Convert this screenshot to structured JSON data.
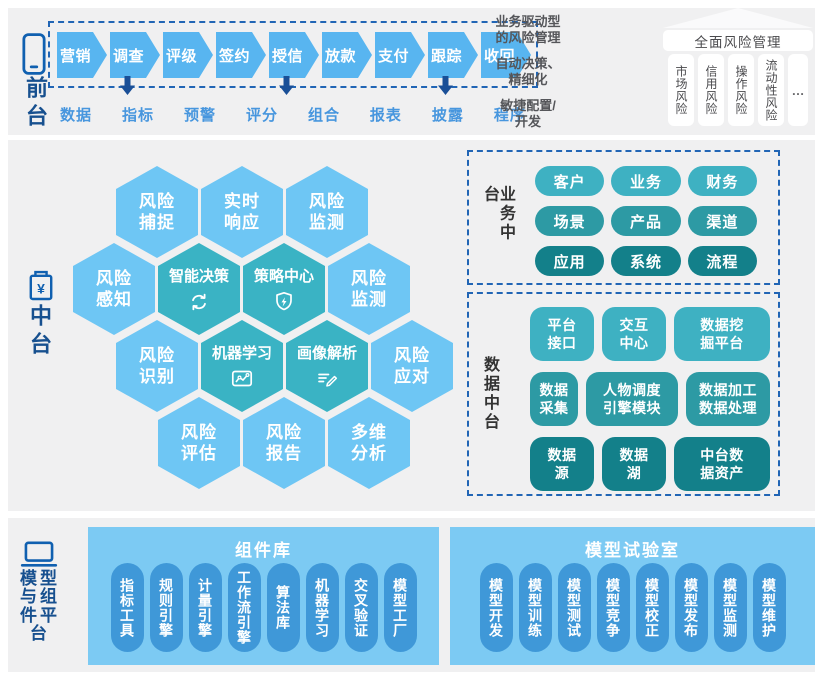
{
  "palette": {
    "band_bg": "#f0f0f1",
    "arrow_blue": "#58b5f0",
    "dashed_border_blue": "#2165b5",
    "down_arrow_navy": "#1a4f97",
    "flow_label_blue": "#4796de",
    "rail_navy": "#17508f",
    "hex_light_blue": "#6ec6f4",
    "hex_teal": "#3ab3c4",
    "pill_teal_light": "#3eb1c2",
    "pill_teal_mid": "#2d9aa4",
    "pill_teal_dark": "#13808a",
    "panel_sky_blue": "#7ccaf3",
    "panel_pill_blue": "#3f98d8"
  },
  "front": {
    "label": "前台",
    "steps": [
      {
        "label": "营销"
      },
      {
        "label": "调查",
        "down": true
      },
      {
        "label": "评级"
      },
      {
        "label": "签约"
      },
      {
        "label": "授信",
        "down": true
      },
      {
        "label": "放款"
      },
      {
        "label": "支付"
      },
      {
        "label": "跟踪",
        "down": true
      },
      {
        "label": "收回"
      }
    ],
    "sub_labels": [
      "数据",
      "指标",
      "预警",
      "评分",
      "组合",
      "报表",
      "披露",
      "程序"
    ],
    "features": [
      {
        "l1": "业务驱动型",
        "l2": "的风险管理"
      },
      {
        "l1": "自动决策、",
        "l2": "精细化"
      },
      {
        "l1": "敏捷配置/",
        "l2": "开发"
      }
    ],
    "comprehensive": {
      "title": "全面风险管理",
      "items": [
        "市场风险",
        "信用风险",
        "操作风险",
        "流动性风险",
        "…"
      ]
    }
  },
  "middle": {
    "label": "中台",
    "hexes": [
      {
        "l1": "风险",
        "l2": "捕捉"
      },
      {
        "l1": "实时",
        "l2": "响应"
      },
      {
        "l1": "风险",
        "l2": "监测"
      },
      {
        "l1": "风险",
        "l2": "感知"
      },
      {
        "t": "智能决策"
      },
      {
        "t": "策略中心"
      },
      {
        "l1": "风险",
        "l2": "监测"
      },
      {
        "l1": "风险",
        "l2": "识别"
      },
      {
        "t": "机器学习"
      },
      {
        "t": "画像解析"
      },
      {
        "l1": "风险",
        "l2": "应对"
      },
      {
        "l1": "风险",
        "l2": "评估"
      },
      {
        "l1": "风险",
        "l2": "报告"
      },
      {
        "l1": "多维",
        "l2": "分析"
      }
    ],
    "business": {
      "label": "业务中台",
      "rows": [
        [
          "客户",
          "业务",
          "财务"
        ],
        [
          "场景",
          "产品",
          "渠道"
        ],
        [
          "应用",
          "系统",
          "流程"
        ]
      ]
    },
    "data": {
      "label": "数据中台",
      "rows": [
        [
          {
            "l1": "平台",
            "l2": "接口"
          },
          {
            "l1": "交互",
            "l2": "中心"
          },
          {
            "l1": "数据挖",
            "l2": "掘平台"
          }
        ],
        [
          {
            "l1": "数据",
            "l2": "采集"
          },
          {
            "l1": "人物调度",
            "l2": "引擎模块"
          },
          {
            "l1": "数据加工",
            "l2": "数据处理"
          }
        ],
        [
          {
            "l1": "数据",
            "l2": "源"
          },
          {
            "l1": "数据",
            "l2": "湖"
          },
          {
            "l1": "中台数",
            "l2": "据资产"
          }
        ]
      ]
    }
  },
  "platform": {
    "label": "模型与组件平台",
    "library": {
      "title": "组件库",
      "items": [
        "指标工具",
        "规则引擎",
        "计量引擎",
        "工作流引擎",
        "算法库",
        "机器学习",
        "交叉验证",
        "模型工厂"
      ]
    },
    "lab": {
      "title": "模型试验室",
      "items": [
        "模型开发",
        "模型训练",
        "模型测试",
        "模型竞争",
        "模型校正",
        "模型发布",
        "模型监测",
        "模型维护"
      ]
    }
  }
}
